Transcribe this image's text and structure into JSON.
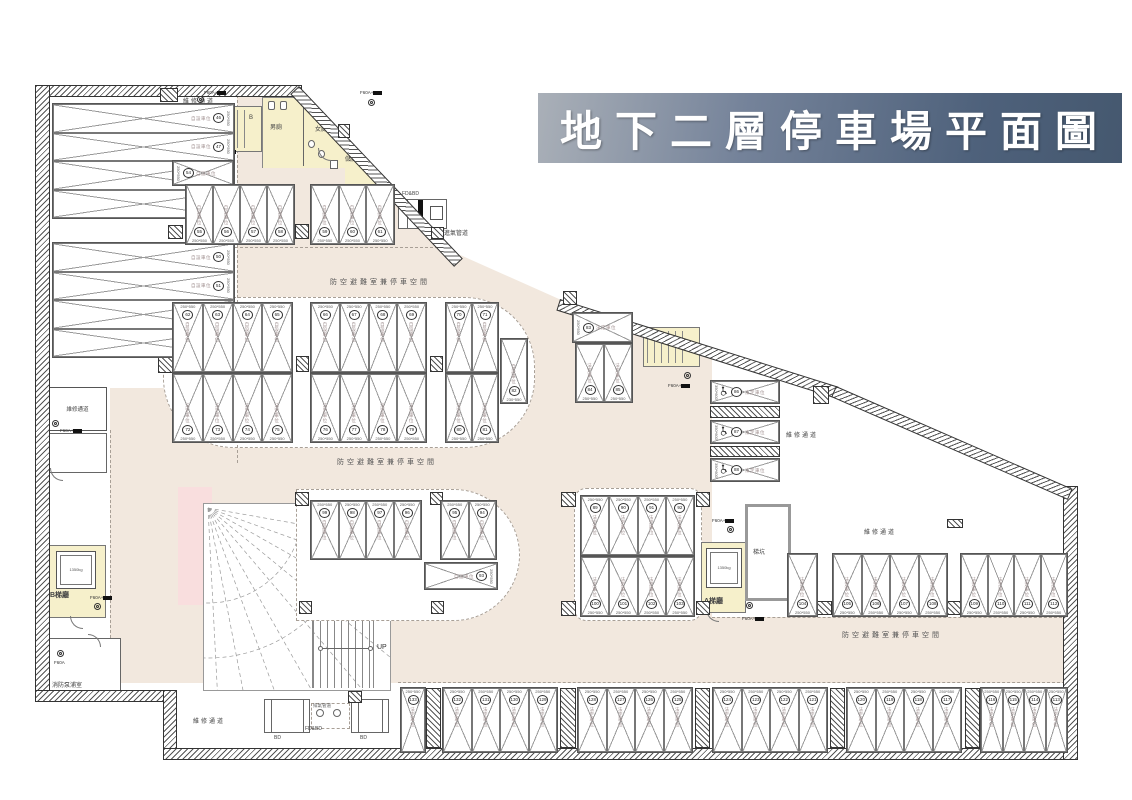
{
  "title": "地下二層停車場平面圖",
  "labels": {
    "maintenance": "維修通道",
    "shelter": "防空避難室兼停車空間",
    "intake": "進氣管道",
    "exhaust": "排氣管道",
    "mens": "男廁",
    "womens": "女廁",
    "storage": "儲藏",
    "pit": "梯坑",
    "stair_a_hall": "A梯廳",
    "stair_b_hall": "B梯廳",
    "pump_room": "消防泵浦室",
    "up": "UP",
    "stair_a": "A",
    "stair_b": "B",
    "bd": "BD",
    "fdbd": "FD&BD",
    "f60a_plus": "F60A+",
    "f60a": "F60A",
    "elevator": "1350kg"
  },
  "stall_types": {
    "private": "自設車位",
    "legal": "法定車位"
  },
  "parking": {
    "groups": [
      {
        "id": "left1",
        "numbers": [
          46,
          47,
          48,
          49
        ],
        "type": "private",
        "dim": "250*550"
      },
      {
        "id": "left2",
        "numbers": [
          50,
          51,
          52,
          53
        ],
        "type": "private",
        "dim": "250*550"
      },
      {
        "id": "s54",
        "numbers": [
          54
        ],
        "type": "private",
        "dim": "250*550"
      },
      {
        "id": "t1",
        "numbers": [
          55,
          56,
          57,
          58
        ],
        "type": "private",
        "dim": "250*550"
      },
      {
        "id": "t2",
        "numbers": [
          59,
          60,
          61
        ],
        "type": "private",
        "dim": "250*550"
      },
      {
        "id": "ct1",
        "numbers": [
          62,
          63,
          64,
          65
        ],
        "type": "private",
        "dim": "250*550"
      },
      {
        "id": "ct2",
        "numbers": [
          66,
          67,
          68,
          69
        ],
        "type": "private",
        "dim": "250*550"
      },
      {
        "id": "ct3",
        "numbers": [
          70,
          71
        ],
        "type": "private",
        "dim": "250*550"
      },
      {
        "id": "cb1",
        "numbers": [
          72,
          73,
          74,
          75
        ],
        "type": "legal",
        "dim": "250*550"
      },
      {
        "id": "cb2",
        "numbers": [
          76,
          77,
          78,
          79
        ],
        "type": "legal",
        "dim": "250*550"
      },
      {
        "id": "cb3",
        "numbers": [
          80,
          81
        ],
        "type": "legal",
        "dim": "250*550"
      },
      {
        "id": "s82",
        "numbers": [
          82
        ],
        "type": "private",
        "dim": "230*550"
      },
      {
        "id": "s83",
        "numbers": [
          83
        ],
        "type": "legal",
        "dim": "250*550"
      },
      {
        "id": "t84",
        "numbers": [
          84,
          85
        ],
        "type": "legal",
        "dim": "250*550"
      },
      {
        "id": "acc1",
        "numbers": [
          86
        ],
        "type": "legal",
        "dim": "350*600"
      },
      {
        "id": "acc2",
        "numbers": [
          87
        ],
        "type": "legal",
        "dim": "350*600"
      },
      {
        "id": "acc3",
        "numbers": [
          88
        ],
        "type": "legal",
        "dim": "350*600"
      },
      {
        "id": "ait",
        "numbers": [
          89,
          90,
          91,
          92
        ],
        "type": "legal",
        "dim": "250*550"
      },
      {
        "id": "s93",
        "numbers": [
          93
        ],
        "type": "private",
        "dim": "250*550"
      },
      {
        "id": "ri1",
        "numbers": [
          99,
          98,
          97,
          96
        ],
        "type": "private",
        "dim": "250*550"
      },
      {
        "id": "ri2",
        "numbers": [
          95,
          94
        ],
        "type": "private",
        "dim": "250*550"
      },
      {
        "id": "aib",
        "numbers": [
          100,
          101,
          102,
          103
        ],
        "type": "legal",
        "dim": "250*550"
      },
      {
        "id": "s104",
        "numbers": [
          104
        ],
        "type": "legal",
        "dim": "250*550"
      },
      {
        "id": "br1",
        "numbers": [
          105,
          106,
          107,
          108
        ],
        "type": "legal",
        "dim": "250*550"
      },
      {
        "id": "br2",
        "numbers": [
          109,
          110,
          111,
          112
        ],
        "type": "legal",
        "dim": "250*550"
      },
      {
        "id": "st1",
        "numbers": [
          133
        ],
        "type": "legal",
        "dim": "250*550"
      },
      {
        "id": "st2",
        "numbers": [
          132,
          131,
          130,
          129
        ],
        "type": "legal",
        "dim": "250*550"
      },
      {
        "id": "st3",
        "numbers": [
          128,
          127,
          126,
          125
        ],
        "type": "legal",
        "dim": "250*550"
      },
      {
        "id": "st4",
        "numbers": [
          124,
          123,
          122,
          121
        ],
        "type": "legal",
        "dim": "250*550"
      },
      {
        "id": "st5",
        "numbers": [
          120,
          119,
          118,
          117
        ],
        "type": "legal",
        "dim": "250*550"
      },
      {
        "id": "st6",
        "numbers": [
          116,
          115,
          114,
          113
        ],
        "type": "legal",
        "dim": "250*550"
      }
    ]
  }
}
